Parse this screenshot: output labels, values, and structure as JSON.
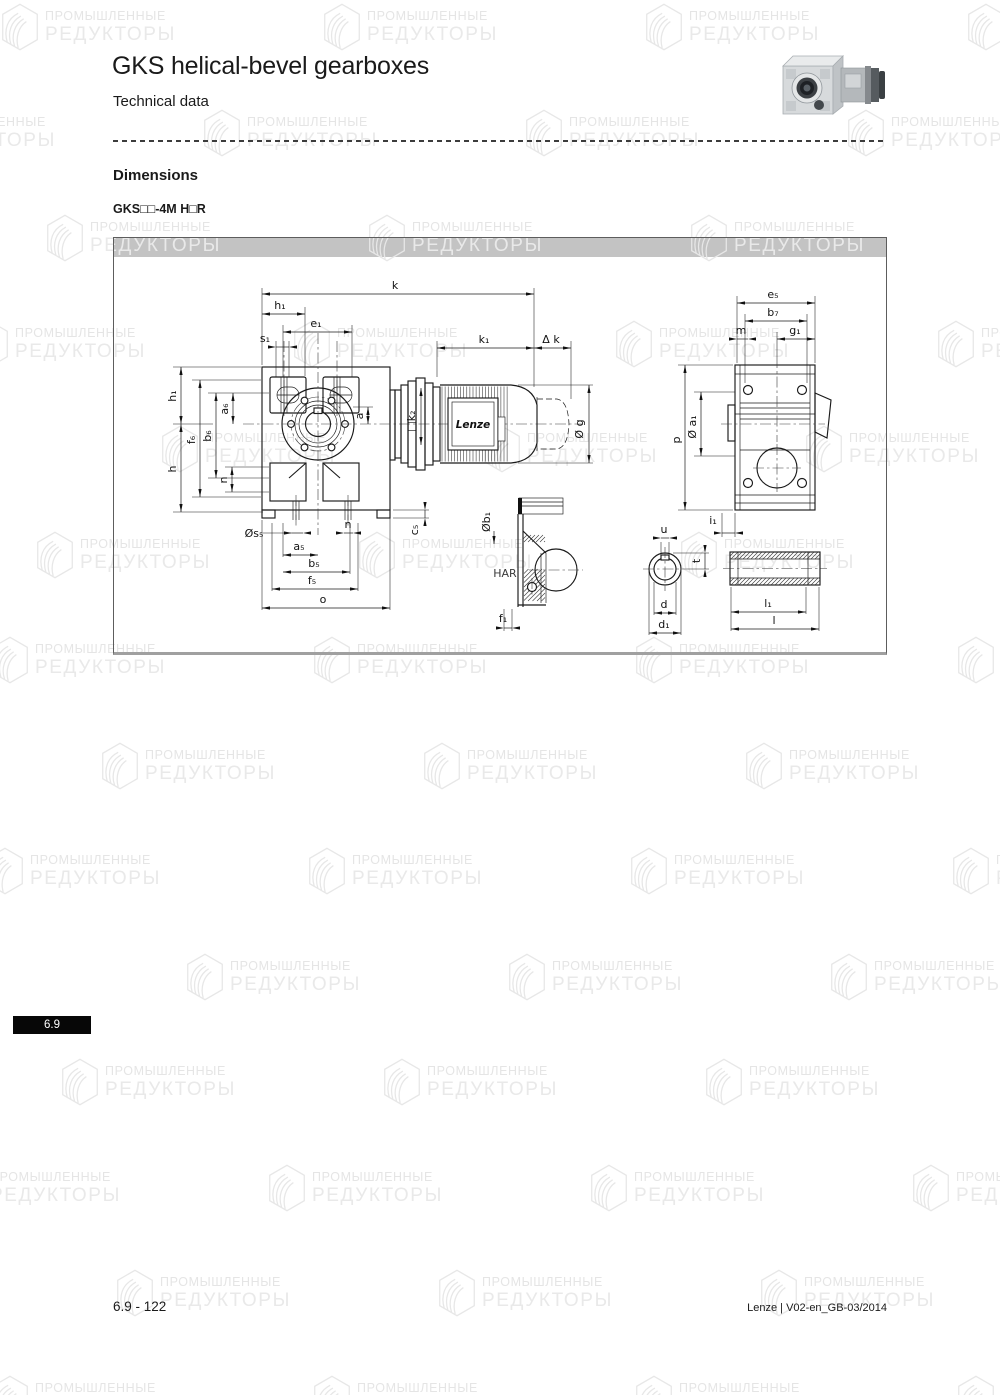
{
  "header": {
    "title": "GKS helical-bevel gearboxes",
    "subtitle": "Technical data"
  },
  "section": {
    "heading": "Dimensions",
    "model": "GKS□□-4M H□R"
  },
  "watermark": {
    "line1": "ПРОМЫШЛЕННЫЕ",
    "line2": "РЕДУКТОРЫ"
  },
  "badge": {
    "chapter": "6.9"
  },
  "footer": {
    "page": "6.9 - 122",
    "doc": "Lenze | V02-en_GB-03/2014"
  },
  "drawing": {
    "motor_brand": "Lenze",
    "view_label": "HAR",
    "labels": {
      "k": "k",
      "k1": "k₁",
      "dk": "Δ k",
      "h1_top": "h₁",
      "e1": "e₁",
      "s1": "s₁",
      "h1_left": "h₁",
      "f6": "f₆",
      "b6": "b₆",
      "a6": "a₆",
      "h": "h",
      "n_left": "n",
      "a": "a",
      "k2": "□k₂",
      "g": "Ø g",
      "e5": "e₅",
      "b7": "b₇",
      "m": "m",
      "g1": "g₁",
      "p": "p",
      "a1": "Ø a₁",
      "i1": "i₁",
      "c5": "c₅",
      "s5": "Øs₅",
      "n_bottom": "n",
      "a5": "a₅",
      "b5": "b₅",
      "f5": "f₅",
      "o": "o",
      "b1": "Øb₁",
      "f1": "f₁",
      "u": "u",
      "t": "t",
      "d": "d",
      "d1": "d₁",
      "l1": "l₁",
      "l": "l"
    }
  }
}
